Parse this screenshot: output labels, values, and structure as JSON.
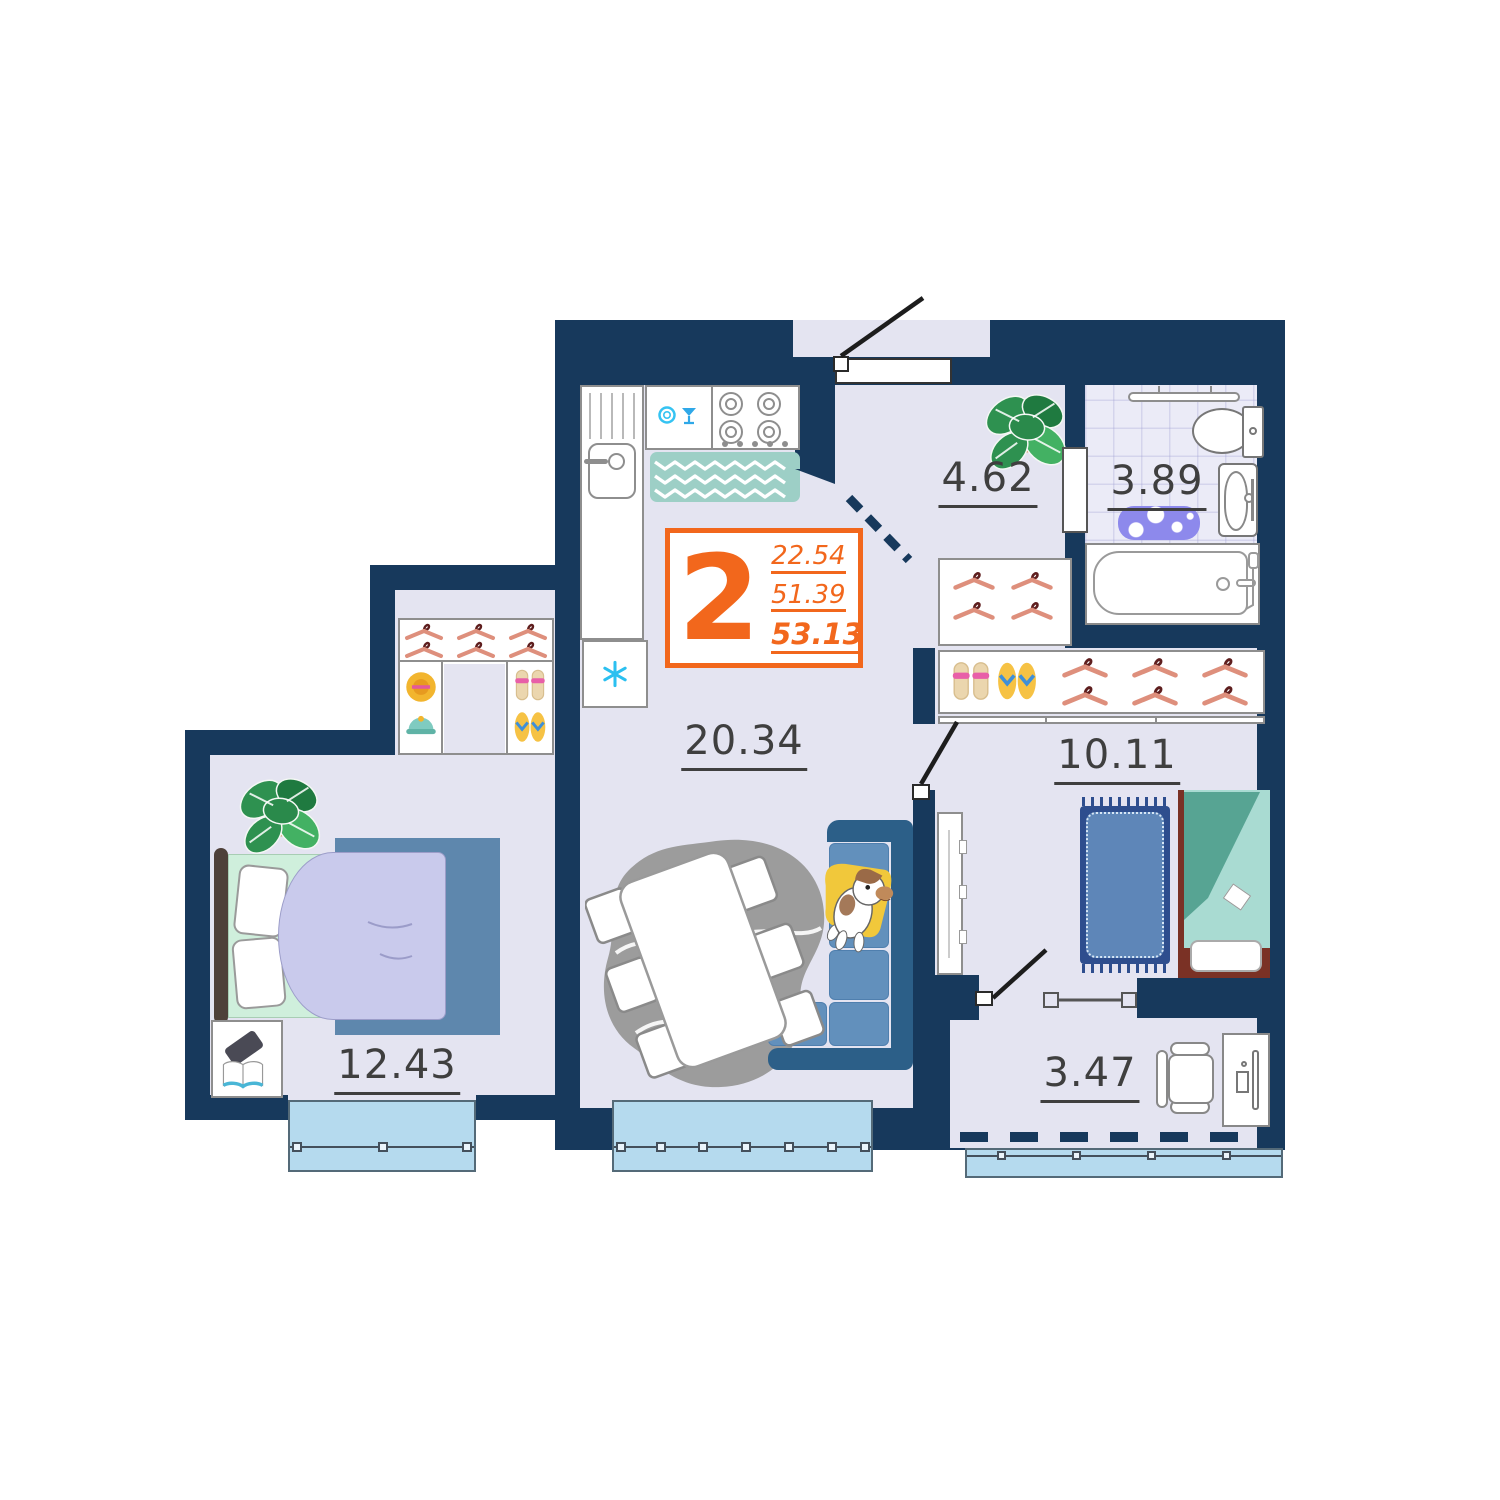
{
  "badge": {
    "room_count": "2",
    "value_top": "22.54",
    "value_middle": "51.39",
    "value_bottom": "53.13"
  },
  "areas": {
    "hallway": "4.62",
    "bathroom": "3.89",
    "kitchen_living": "20.34",
    "bedroom_right": "10.11",
    "bedroom_left": "12.43",
    "balcony": "3.47"
  },
  "colors": {
    "wall": "#17395C",
    "floor": "#E4E4F1",
    "window_glass": "#B5DAEE",
    "accent": "#F2671C"
  }
}
